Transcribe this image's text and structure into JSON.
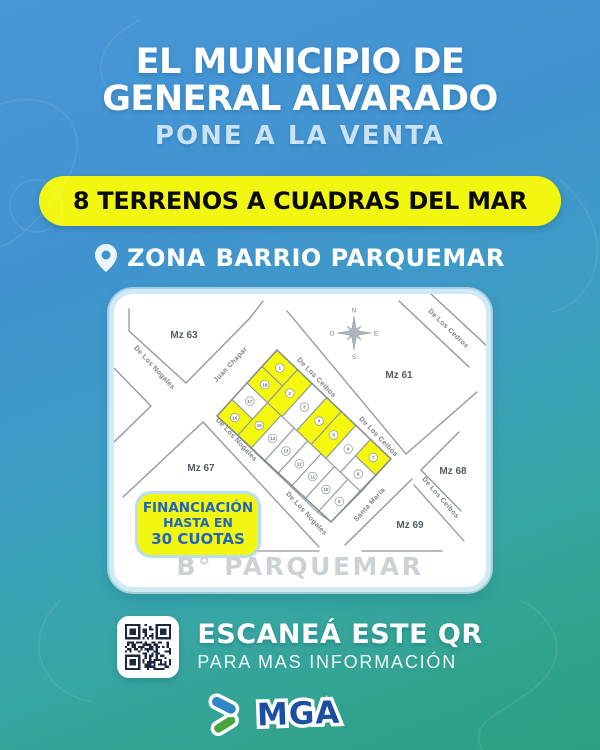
{
  "header": {
    "title_line1": "EL MUNICIPIO DE",
    "title_line2": "GENERAL ALVARADO",
    "subtitle": "PONE A LA VENTA",
    "banner": "8 TERRENOS A CUADRAS DEL MAR",
    "location_prefix": "ZONA",
    "location_name": "BARRIO PARQUEMAR"
  },
  "map": {
    "manzanas": {
      "mz63": "Mz 63",
      "mz61": "Mz 61",
      "mz67": "Mz 67",
      "mz68": "Mz 68",
      "mz69": "Mz 69"
    },
    "streets": {
      "nogales": "De Los Nogales",
      "chapar": "Juan Chapar",
      "ceibos": "De Los Ceibos",
      "cedros": "De Los Cedros",
      "santa_maria": "Santa María"
    },
    "compass": {
      "north": "N",
      "south": "S",
      "east": "E",
      "west": "O"
    },
    "highlighted_lots_count": 8,
    "lots": [
      {
        "number": "1",
        "highlighted": true
      },
      {
        "number": "2",
        "highlighted": true
      },
      {
        "number": "3",
        "highlighted": false
      },
      {
        "number": "4",
        "highlighted": true
      },
      {
        "number": "5",
        "highlighted": true
      },
      {
        "number": "6",
        "highlighted": false
      },
      {
        "number": "7",
        "highlighted": true
      },
      {
        "number": "8",
        "highlighted": false
      },
      {
        "number": "9",
        "highlighted": false
      },
      {
        "number": "10",
        "highlighted": false
      },
      {
        "number": "11",
        "highlighted": false
      },
      {
        "number": "12",
        "highlighted": false
      },
      {
        "number": "13",
        "highlighted": false
      },
      {
        "number": "14",
        "highlighted": false
      },
      {
        "number": "15",
        "highlighted": true
      },
      {
        "number": "16",
        "highlighted": true
      },
      {
        "number": "17",
        "highlighted": false
      },
      {
        "number": "18",
        "highlighted": true
      }
    ],
    "financing_badge": {
      "line1": "FINANCIACIÓN",
      "line2": "HASTA EN",
      "line3": "30 CUOTAS"
    },
    "neighborhood_label": "B° PARQUEMAR"
  },
  "qr_section": {
    "heading": "ESCANEÁ ESTE QR",
    "subheading": "PARA MAS INFORMACIÓN"
  },
  "logo": {
    "text": "MGA"
  },
  "colors": {
    "background_top": "#4796D8",
    "background_bottom": "#2F9F84",
    "accent_yellow": "#F2F711",
    "subtitle_light_blue": "#C9E2F4",
    "badge_text_blue": "#2264BE",
    "lot_highlight_yellow": "#F4F80C",
    "logo_blue": "#1B4F9F",
    "logo_green": "#46A63B",
    "map_text_gray": "#7C8287"
  }
}
